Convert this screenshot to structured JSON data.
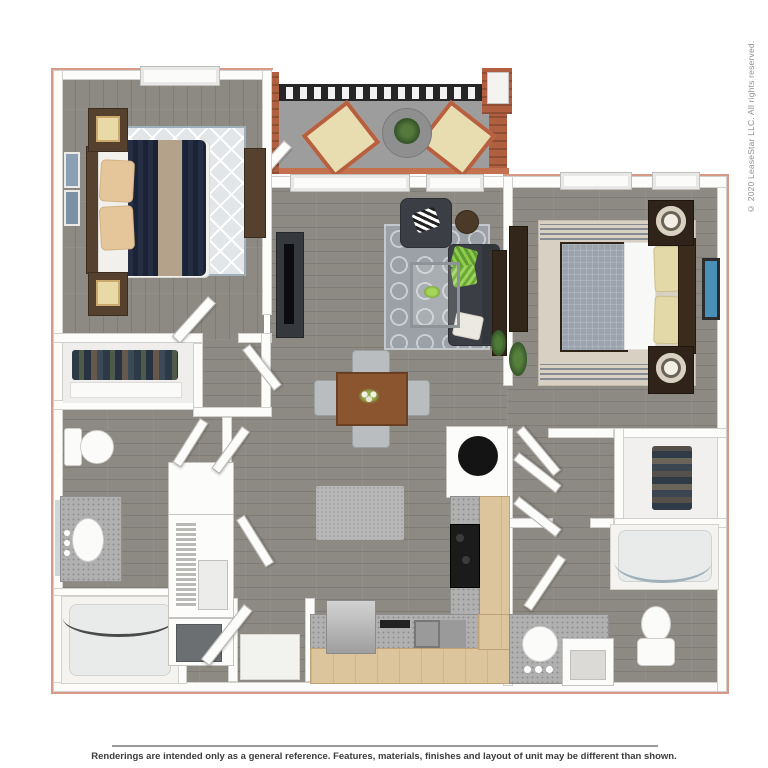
{
  "copyright": "© 2020 LeaseStar LLC. All rights reserved.",
  "disclaimer": "Renderings are intended only as a general reference. Features, materials, finishes and layout of unit may be different than shown.",
  "colors": {
    "outline": "#d89a86",
    "wall": "#fcfcfb",
    "wall_edge": "#d2d0cd",
    "floor": "#8d8983",
    "balcony": "#9d9d9d",
    "brick": "#b05f41",
    "railing": "#262626",
    "navy": "#1b2337",
    "rug_light": "#e2e6e9",
    "rug_gray": "#9ba1a6",
    "sofa": "#3b3e44",
    "green": "#7fb843",
    "wood_dark": "#55412e",
    "table_wood": "#8a552f",
    "cabinet": "#dcc49c",
    "counter": "#b0b0b0",
    "cream": "#e3d9a8",
    "bed2_gray": "#9ba3ad"
  }
}
